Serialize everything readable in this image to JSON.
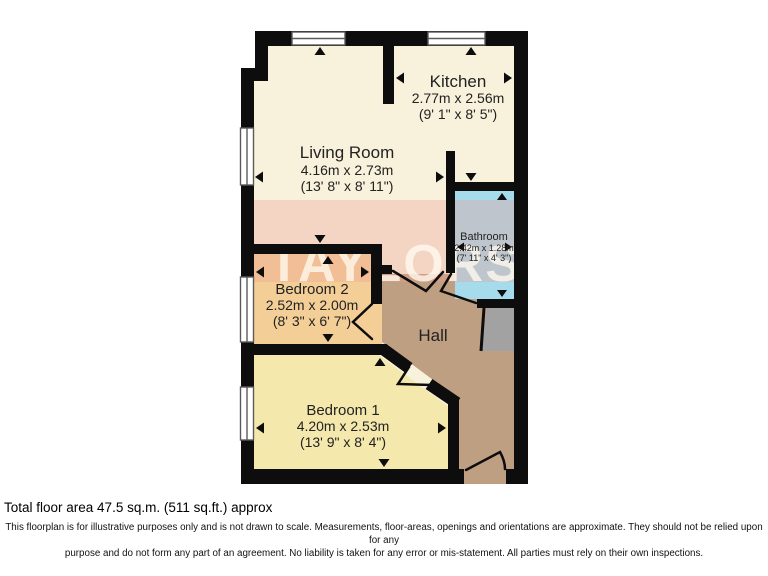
{
  "watermark": "TAYLORS",
  "rooms": {
    "living_room": {
      "name": "Living Room",
      "metric": "4.16m x 2.73m",
      "imperial": "(13' 8\" x 8' 11\")"
    },
    "kitchen": {
      "name": "Kitchen",
      "metric": "2.77m x 2.56m",
      "imperial": "(9' 1\" x 8' 5\")"
    },
    "bathroom": {
      "name": "Bathroom",
      "metric": "2.42m x 1.28m",
      "imperial": "(7' 11\" x 4' 3\")"
    },
    "bedroom_2": {
      "name": "Bedroom 2",
      "metric": "2.52m x 2.00m",
      "imperial": "(8' 3\" x 6' 7\")"
    },
    "bedroom_1": {
      "name": "Bedroom 1",
      "metric": "4.20m x 2.53m",
      "imperial": "(13' 9\" x 8' 4\")"
    },
    "hall": {
      "name": "Hall"
    }
  },
  "footer": {
    "total_area": "Total floor area 47.5 sq.m. (511 sq.ft.) approx",
    "disclaimer_line1": "This floorplan is for illustrative purposes only and is not drawn to scale. Measurements, floor-areas, openings and orientations are approximate. They should not be relied upon for any",
    "disclaimer_line2": "purpose and do not form any part of an agreement. No liability is taken for any error or mis-statement. All parties must rely on their own inspections."
  },
  "colors": {
    "wall": "#0d0d0d",
    "room_cream": "#f8f2dc",
    "bathroom_blue": "#a5dbeb",
    "bedroom2_orange": "#f3cf97",
    "bedroom1_yellow": "#f5e8ad",
    "hall_tan": "#bf9f82",
    "storage_gray": "#a2a2a2",
    "watermark_band": "#ee9f93"
  }
}
